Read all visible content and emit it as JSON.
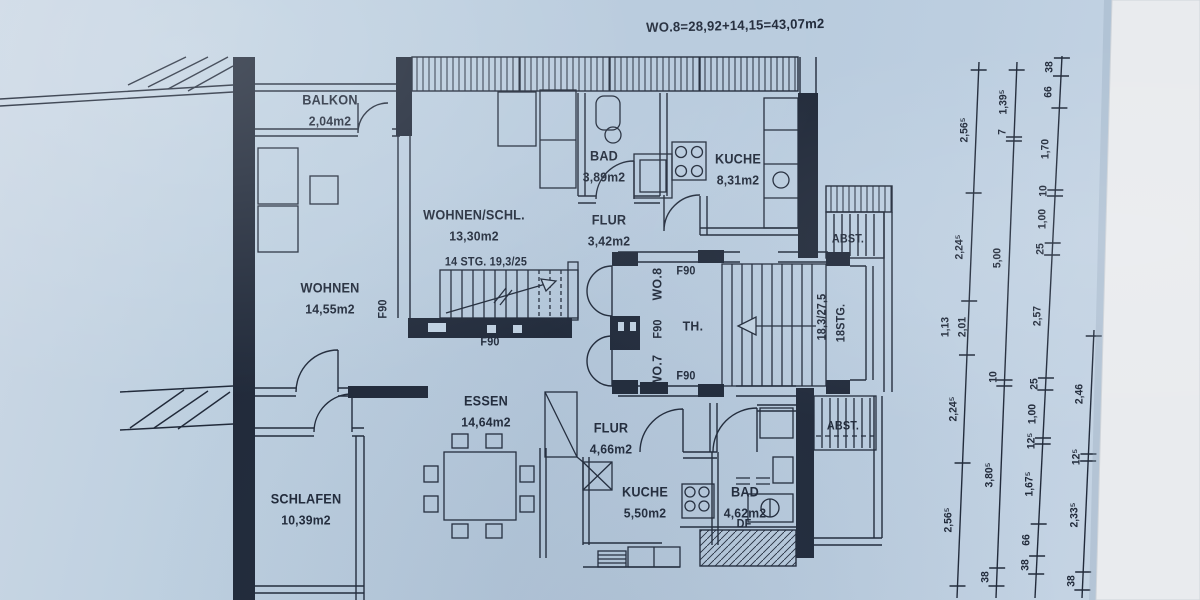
{
  "title": "WO.8=28,92+14,15=43,07m2",
  "colors": {
    "paper": "#bfd0e1",
    "ink": "#212a3a",
    "photo_edge": "#e9ebee"
  },
  "rooms": [
    {
      "name": "BALKON",
      "area": "2,04m2",
      "x": 330,
      "y": 110
    },
    {
      "name": "WOHNEN/SCHL.",
      "area": "13,30m2",
      "x": 474,
      "y": 225
    },
    {
      "name": "BAD",
      "area": "3,89m2",
      "x": 604,
      "y": 166
    },
    {
      "name": "KUCHE",
      "area": "8,31m2",
      "x": 738,
      "y": 169
    },
    {
      "name": "FLUR",
      "area": "3,42m2",
      "x": 609,
      "y": 230
    },
    {
      "name": "WOHNEN",
      "area": "14,55m2",
      "x": 330,
      "y": 298
    },
    {
      "name": "ESSEN",
      "area": "14,64m2",
      "x": 486,
      "y": 411
    },
    {
      "name": "FLUR",
      "area": "4,66m2",
      "x": 611,
      "y": 438
    },
    {
      "name": "SCHLAFEN",
      "area": "10,39m2",
      "x": 306,
      "y": 509
    },
    {
      "name": "KUCHE",
      "area": "5,50m2",
      "x": 645,
      "y": 502
    },
    {
      "name": "BAD",
      "area": "4,62m2",
      "x": 745,
      "y": 502
    }
  ],
  "annotations": [
    {
      "text": "14 STG. 19,3/25",
      "x": 486,
      "y": 263,
      "orient": "h"
    },
    {
      "text": "F90",
      "x": 384,
      "y": 309,
      "orient": "v"
    },
    {
      "text": "F90",
      "x": 490,
      "y": 343,
      "orient": "h"
    },
    {
      "text": "WO.8",
      "x": 657,
      "y": 284,
      "orient": "v",
      "big": true
    },
    {
      "text": "F90",
      "x": 659,
      "y": 329,
      "orient": "v"
    },
    {
      "text": "WO.7",
      "x": 657,
      "y": 371,
      "orient": "v",
      "big": true
    },
    {
      "text": "F90",
      "x": 686,
      "y": 272,
      "orient": "h"
    },
    {
      "text": "TH.",
      "x": 693,
      "y": 326,
      "orient": "h",
      "big": true
    },
    {
      "text": "F90",
      "x": 686,
      "y": 377,
      "orient": "h"
    },
    {
      "text": "18,3/27,5",
      "x": 823,
      "y": 317,
      "orient": "v"
    },
    {
      "text": "18STG.",
      "x": 842,
      "y": 323,
      "orient": "v"
    },
    {
      "text": "ABST.",
      "x": 848,
      "y": 240,
      "orient": "h"
    },
    {
      "text": "ABST.",
      "x": 843,
      "y": 427,
      "orient": "h"
    },
    {
      "text": "DF",
      "x": 744,
      "y": 525,
      "orient": "h"
    }
  ],
  "dimensions": {
    "columns": [
      {
        "name": "chain-outer",
        "x_top": 979,
        "y_top": 62,
        "x_bottom": 957,
        "y_bottom": 598,
        "ticks": [
          70,
          193,
          301,
          355,
          463,
          586
        ],
        "labels": [
          {
            "t": "2,56⁵",
            "y": 130
          },
          {
            "t": "2,24⁵",
            "y": 247
          },
          {
            "t": "1,13",
            "y": 327,
            "dx": -22
          },
          {
            "t": "2,01",
            "y": 327,
            "dx": -5
          },
          {
            "t": "2,24⁵",
            "y": 409
          },
          {
            "t": "2,56⁵",
            "y": 520
          }
        ]
      },
      {
        "name": "chain-mid",
        "x_top": 1017,
        "y_top": 62,
        "x_bottom": 996,
        "y_bottom": 598,
        "ticks": [
          70,
          137,
          141,
          380,
          386,
          568,
          586
        ],
        "labels": [
          {
            "t": "1,39⁵",
            "y": 102
          },
          {
            "t": "7",
            "y": 132
          },
          {
            "t": "5,00",
            "y": 258
          },
          {
            "t": "10",
            "y": 377
          },
          {
            "t": "3,80⁵",
            "y": 475
          },
          {
            "t": "38",
            "y": 577
          }
        ]
      },
      {
        "name": "chain-detail",
        "x_top": 1062,
        "y_top": 56,
        "x_bottom": 1035,
        "y_bottom": 598,
        "ticks": [
          58,
          76,
          108,
          190,
          196,
          243,
          255,
          378,
          390,
          438,
          444,
          524,
          556,
          574
        ],
        "labels": [
          {
            "t": "38",
            "y": 67
          },
          {
            "t": "66",
            "y": 92
          },
          {
            "t": "1,70",
            "y": 149
          },
          {
            "t": "10",
            "y": 191
          },
          {
            "t": "1,00",
            "y": 219
          },
          {
            "t": "25",
            "y": 249
          },
          {
            "t": "2,57",
            "y": 316
          },
          {
            "t": "25",
            "y": 384
          },
          {
            "t": "1,00",
            "y": 414
          },
          {
            "t": "12⁵",
            "y": 441
          },
          {
            "t": "1,67⁵",
            "y": 484
          },
          {
            "t": "66",
            "y": 540
          },
          {
            "t": "38",
            "y": 565
          }
        ]
      },
      {
        "name": "chain-edge",
        "x_top": 1094,
        "y_top": 330,
        "x_bottom": 1082,
        "y_bottom": 598,
        "ticks": [
          336,
          454,
          461,
          572,
          590
        ],
        "labels": [
          {
            "t": "2,46",
            "y": 394
          },
          {
            "t": "12⁵",
            "y": 457
          },
          {
            "t": "2,33⁵",
            "y": 515
          },
          {
            "t": "38",
            "y": 581
          }
        ]
      }
    ]
  }
}
